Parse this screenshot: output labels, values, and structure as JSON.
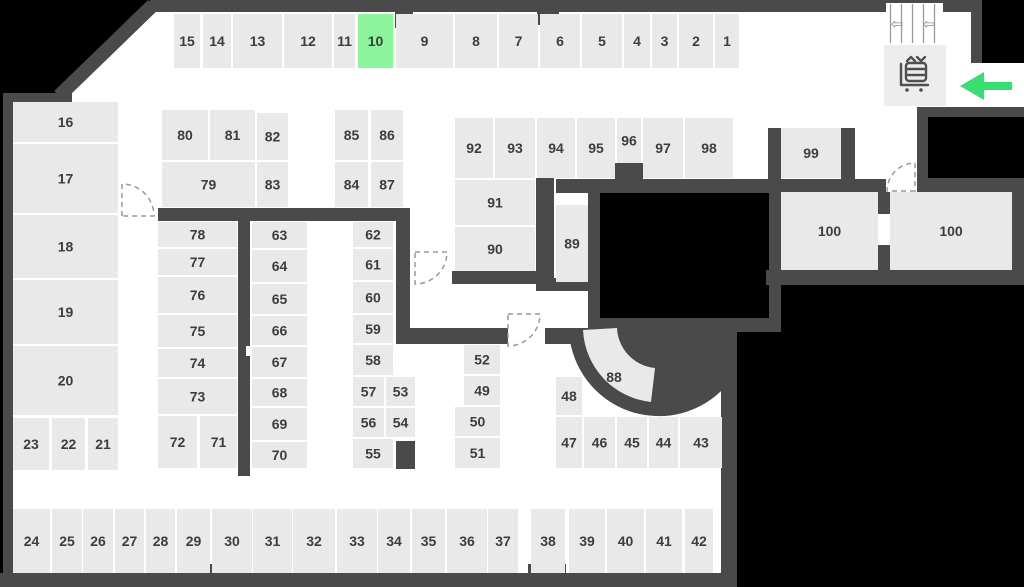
{
  "map": {
    "title": "facility-floor-plan",
    "highlighted_unit": "10",
    "units": [
      [
        "15",
        174,
        14,
        26,
        54,
        ""
      ],
      [
        "14",
        203,
        14,
        28,
        54,
        ""
      ],
      [
        "13",
        233,
        14,
        49,
        54,
        ""
      ],
      [
        "12",
        284,
        14,
        48,
        54,
        ""
      ],
      [
        "11",
        334,
        14,
        21,
        54,
        ""
      ],
      [
        "10",
        358,
        14,
        35,
        54,
        "highlight"
      ],
      [
        "9",
        396,
        14,
        57,
        54,
        ""
      ],
      [
        "8",
        455,
        14,
        42,
        54,
        ""
      ],
      [
        "7",
        499,
        14,
        39,
        54,
        ""
      ],
      [
        "6",
        540,
        14,
        40,
        54,
        ""
      ],
      [
        "5",
        582,
        14,
        40,
        54,
        ""
      ],
      [
        "4",
        624,
        14,
        26,
        54,
        ""
      ],
      [
        "3",
        652,
        14,
        25,
        54,
        ""
      ],
      [
        "2",
        679,
        14,
        34,
        54,
        ""
      ],
      [
        "1",
        715,
        14,
        24,
        54,
        ""
      ],
      [
        "16",
        13,
        102,
        105,
        40,
        ""
      ],
      [
        "17",
        13,
        144,
        105,
        69,
        ""
      ],
      [
        "18",
        13,
        215,
        105,
        63,
        ""
      ],
      [
        "19",
        13,
        280,
        105,
        64,
        ""
      ],
      [
        "20",
        13,
        346,
        105,
        69,
        ""
      ],
      [
        "23",
        13,
        418,
        36,
        52,
        ""
      ],
      [
        "22",
        52,
        418,
        33,
        52,
        ""
      ],
      [
        "21",
        88,
        418,
        30,
        52,
        ""
      ],
      [
        "80",
        162,
        110,
        46,
        50,
        ""
      ],
      [
        "81",
        210,
        110,
        45,
        50,
        ""
      ],
      [
        "82",
        257,
        113,
        31,
        47,
        ""
      ],
      [
        "79",
        162,
        162,
        93,
        45,
        ""
      ],
      [
        "83",
        257,
        162,
        31,
        45,
        ""
      ],
      [
        "85",
        335,
        110,
        33,
        50,
        ""
      ],
      [
        "86",
        371,
        110,
        32,
        50,
        ""
      ],
      [
        "84",
        335,
        162,
        33,
        45,
        ""
      ],
      [
        "87",
        371,
        162,
        32,
        45,
        ""
      ],
      [
        "78",
        158,
        222,
        79,
        25,
        ""
      ],
      [
        "77",
        158,
        249,
        79,
        26,
        ""
      ],
      [
        "76",
        158,
        277,
        79,
        36,
        ""
      ],
      [
        "75",
        158,
        315,
        79,
        32,
        ""
      ],
      [
        "74",
        158,
        349,
        79,
        28,
        ""
      ],
      [
        "73",
        158,
        379,
        79,
        35,
        ""
      ],
      [
        "72",
        158,
        416,
        39,
        52,
        ""
      ],
      [
        "71",
        200,
        416,
        37,
        52,
        ""
      ],
      [
        "63",
        252,
        222,
        55,
        26,
        ""
      ],
      [
        "64",
        252,
        250,
        55,
        32,
        ""
      ],
      [
        "65",
        252,
        284,
        55,
        30,
        ""
      ],
      [
        "66",
        252,
        316,
        55,
        29,
        ""
      ],
      [
        "67",
        252,
        347,
        55,
        30,
        ""
      ],
      [
        "68",
        252,
        379,
        55,
        27,
        ""
      ],
      [
        "69",
        252,
        408,
        55,
        32,
        ""
      ],
      [
        "70",
        252,
        442,
        55,
        26,
        ""
      ],
      [
        "62",
        353,
        222,
        40,
        25,
        ""
      ],
      [
        "61",
        353,
        249,
        40,
        31,
        ""
      ],
      [
        "60",
        353,
        282,
        40,
        31,
        ""
      ],
      [
        "59",
        353,
        315,
        40,
        28,
        ""
      ],
      [
        "58",
        353,
        345,
        40,
        30,
        ""
      ],
      [
        "57",
        353,
        377,
        31,
        29,
        ""
      ],
      [
        "53",
        386,
        377,
        29,
        29,
        ""
      ],
      [
        "56",
        353,
        408,
        31,
        29,
        ""
      ],
      [
        "54",
        386,
        408,
        29,
        29,
        ""
      ],
      [
        "55",
        353,
        439,
        40,
        29,
        ""
      ],
      [
        "52",
        464,
        345,
        36,
        29,
        ""
      ],
      [
        "49",
        464,
        376,
        36,
        29,
        ""
      ],
      [
        "50",
        455,
        407,
        45,
        29,
        ""
      ],
      [
        "51",
        455,
        438,
        45,
        30,
        ""
      ],
      [
        "48",
        556,
        377,
        26,
        38,
        ""
      ],
      [
        "47",
        556,
        417,
        26,
        51,
        ""
      ],
      [
        "46",
        584,
        417,
        31,
        51,
        ""
      ],
      [
        "45",
        617,
        417,
        30,
        51,
        ""
      ],
      [
        "44",
        649,
        417,
        29,
        51,
        ""
      ],
      [
        "43",
        680,
        417,
        42,
        51,
        ""
      ],
      [
        "92",
        455,
        118,
        38,
        60,
        ""
      ],
      [
        "93",
        495,
        118,
        40,
        60,
        ""
      ],
      [
        "94",
        537,
        118,
        38,
        60,
        ""
      ],
      [
        "95",
        577,
        118,
        38,
        60,
        ""
      ],
      [
        "96",
        617,
        118,
        24,
        45,
        ""
      ],
      [
        "97",
        643,
        118,
        40,
        60,
        ""
      ],
      [
        "98",
        685,
        118,
        48,
        60,
        ""
      ],
      [
        "91",
        455,
        180,
        80,
        45,
        ""
      ],
      [
        "90",
        455,
        227,
        80,
        44,
        ""
      ],
      [
        "89",
        556,
        205,
        32,
        77,
        ""
      ],
      [
        "88",
        590,
        362,
        48,
        30,
        "labelonly"
      ],
      [
        "99",
        781,
        128,
        60,
        50,
        ""
      ],
      [
        "100",
        781,
        192,
        97,
        78,
        ""
      ],
      [
        "100",
        890,
        192,
        122,
        78,
        ""
      ],
      [
        "24",
        13,
        509,
        37,
        64,
        ""
      ],
      [
        "25",
        52,
        509,
        30,
        64,
        ""
      ],
      [
        "26",
        83,
        509,
        30,
        64,
        ""
      ],
      [
        "27",
        115,
        509,
        29,
        64,
        ""
      ],
      [
        "28",
        146,
        509,
        29,
        64,
        ""
      ],
      [
        "29",
        177,
        509,
        33,
        64,
        ""
      ],
      [
        "30",
        212,
        509,
        40,
        64,
        ""
      ],
      [
        "31",
        253,
        509,
        39,
        64,
        ""
      ],
      [
        "32",
        293,
        509,
        42,
        64,
        ""
      ],
      [
        "33",
        337,
        509,
        40,
        64,
        ""
      ],
      [
        "34",
        378,
        509,
        32,
        64,
        ""
      ],
      [
        "35",
        412,
        509,
        33,
        64,
        ""
      ],
      [
        "36",
        447,
        509,
        40,
        64,
        ""
      ],
      [
        "37",
        488,
        509,
        30,
        64,
        ""
      ],
      [
        "38",
        531,
        509,
        34,
        64,
        ""
      ],
      [
        "39",
        569,
        509,
        36,
        64,
        ""
      ],
      [
        "40",
        607,
        509,
        37,
        64,
        ""
      ],
      [
        "41",
        646,
        509,
        36,
        64,
        ""
      ],
      [
        "42",
        685,
        509,
        28,
        64,
        ""
      ]
    ],
    "stairs": {
      "arrows": [
        "⇦",
        "⇦"
      ]
    }
  },
  "colors": {
    "outside": "#000000",
    "floor": "#ffffff",
    "wall": "#4a4a4a",
    "unit_fill": "#e9e9e9",
    "highlight_fill": "#8df59e",
    "label": "#3d3d3d",
    "entrance_arrow": "#35e071",
    "door_dash": "#999999"
  }
}
